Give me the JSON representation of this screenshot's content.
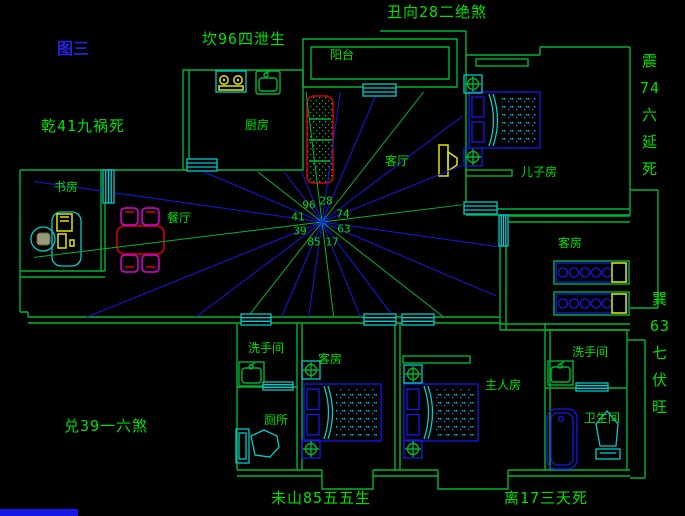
{
  "figure_label": "图三",
  "direction_annotations": {
    "north": "坎96四泄生",
    "northeast": "丑向28二绝煞",
    "northwest": "乾41九祸死",
    "east_vertical": "震\n74\n六\n延\n死",
    "southeast_vertical": "巽\n63\n七\n伏\n旺",
    "west": "兑39一六煞",
    "south_left": "未山85五五生",
    "south_right": "离17三天死"
  },
  "compass_numbers": {
    "tl": "96",
    "t": "28",
    "l": "41",
    "rt": "74",
    "bl": "39",
    "r": "63",
    "b": "85",
    "br": "17"
  },
  "rooms": {
    "balcony": "阳台",
    "kitchen": "厨房",
    "living": "客厅",
    "study": "书房",
    "dining": "餐厅",
    "son": "儿子房",
    "guest_east": "客房",
    "washroom_left": "洗手间",
    "toilet": "厕所",
    "guest_south": "客房",
    "master": "主人房",
    "washroom_right": "洗手间",
    "bathroom": "卫生间"
  },
  "colors": {
    "wall": "#00b432",
    "text": "#00e000",
    "blue": "#1616e6",
    "cyan": "#00cccc",
    "yellow": "#e6e600",
    "red": "#dd0000",
    "magenta": "#dd00dd",
    "figure_blue": "#2222dd"
  }
}
